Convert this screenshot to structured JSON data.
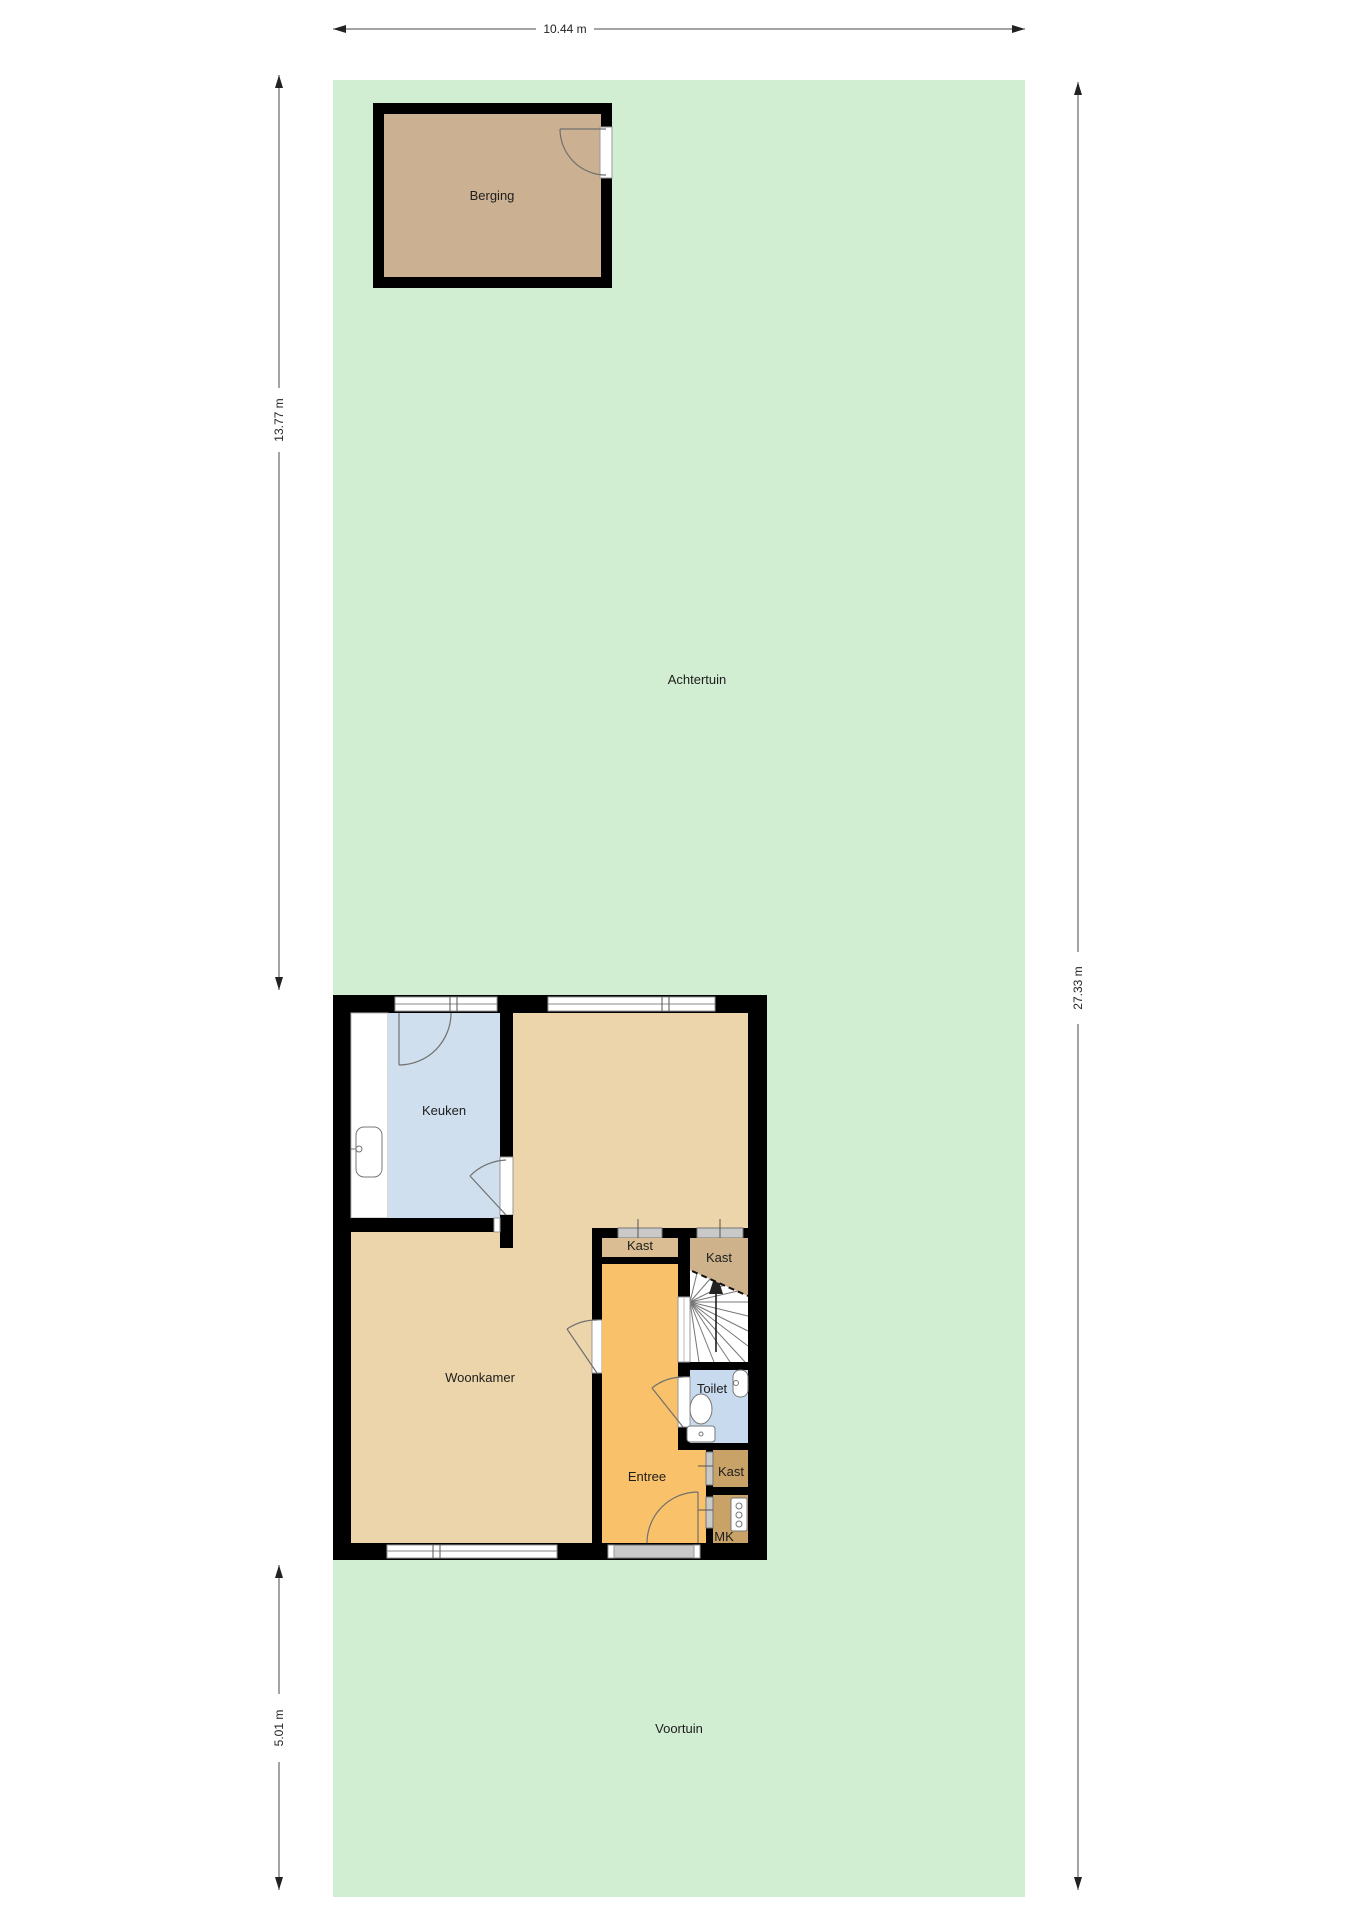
{
  "diagram": {
    "type": "floorplan-ground-floor-with-garden",
    "rooms": {
      "achtertuin": "Achtertuin",
      "voortuin": "Voortuin",
      "berging": "Berging",
      "keuken": "Keuken",
      "woonkamer": "Woonkamer",
      "kast1": "Kast",
      "kast2": "Kast",
      "kast3": "Kast",
      "toilet": "Toilet",
      "entree": "Entree",
      "mk": "MK"
    },
    "dimensions": {
      "top_width": "10.44 m",
      "left_upper": "13.77 m",
      "left_lower": "5.01 m",
      "right_total": "27.33 m"
    },
    "palette": {
      "garden": "#d1eed2",
      "shed": "#cbb191",
      "living": "#edd5ab",
      "kitchen": "#cfdfed",
      "toilet": "#c8dbee",
      "entree": "#f9c169",
      "closet_light": "#dabd92",
      "closet_mid": "#cdb28c",
      "closet_dark": "#c9a268",
      "wall": "#000000",
      "door_band": "#c9c9c9"
    }
  }
}
